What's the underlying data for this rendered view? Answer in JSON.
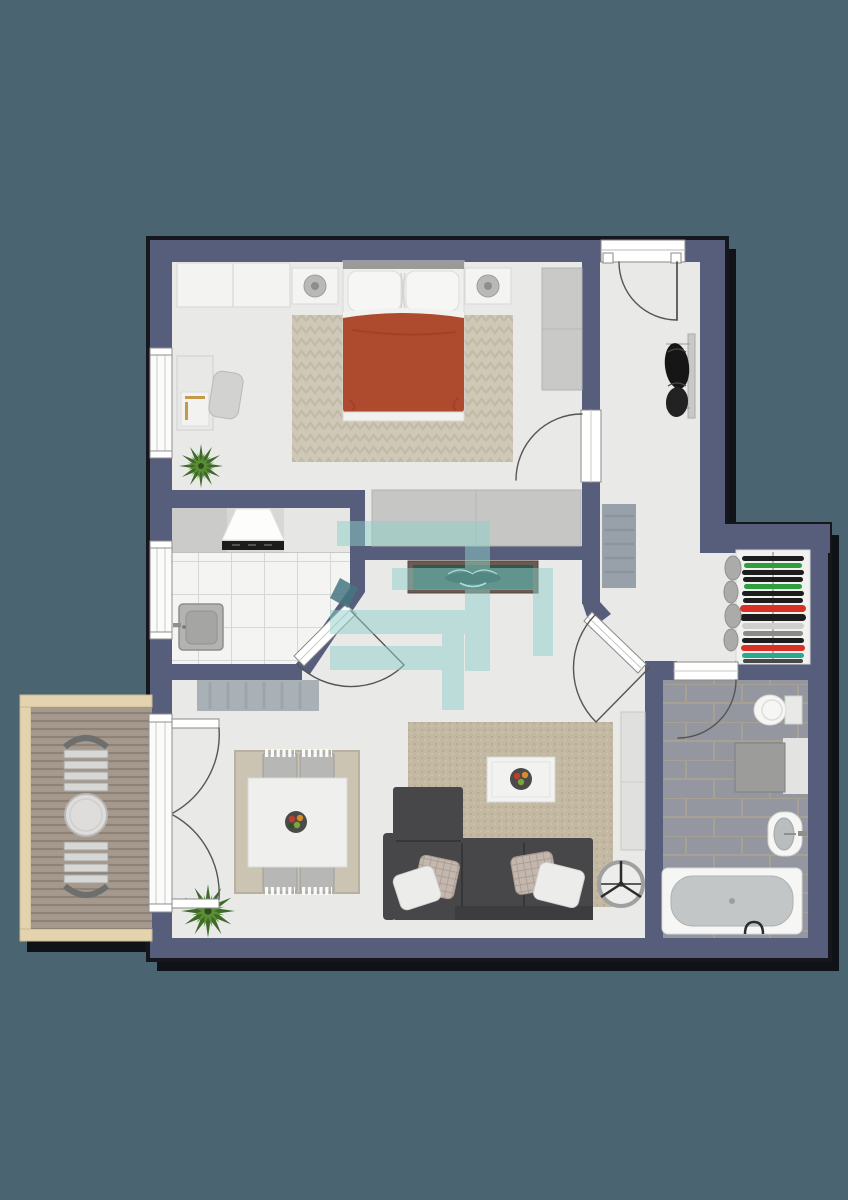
{
  "scene": {
    "type": "floor-plan",
    "view": "top-down-render",
    "description": "Furnished apartment floor plan: bedroom, kitchen, entrance hallway, walk-in wardrobe nook, bathroom, combined living/dining room and a wooden balcony, overlaid with a translucent teal logo watermark"
  },
  "colors": {
    "background": "#4a6571",
    "shadow": "#07090c",
    "wall": "#575e7c",
    "floor": "#e9e9e8",
    "kitchen_tile": "#f4f4f3",
    "bathroom_tile": "#9597a0",
    "bedroom_rug": "#cfc8b7",
    "living_rug": "#c3b8a2",
    "dining_rug": "#ccc4b3",
    "deck": "#a4978c",
    "deck_frame": "#e3d3ae",
    "duvet": "#ae4a2e",
    "sofa": "#474749",
    "watermark": "#8ed1c9",
    "console_top": "#32574f",
    "plant": "#3f6b28",
    "fixture_white": "#f6f6f5",
    "clothes_palette": [
      "#1d1d1d",
      "#2f9e3f",
      "#d93026",
      "#2aa98c",
      "#cfcfcd",
      "#8a8a88"
    ]
  },
  "watermark": {
    "description": "translucent stylized spiral-S logo over hallway",
    "opacity": 0.5
  },
  "rooms": [
    {
      "name": "bedroom",
      "objects": [
        "double bed with terracotta duvet and two pillows",
        "nightstand with lamp x2",
        "dresser",
        "tall side wardrobe",
        "low closet on south wall",
        "desk with chair",
        "herringbone rug",
        "potted plant",
        "window"
      ]
    },
    {
      "name": "kitchen",
      "objects": [
        "counter run",
        "extractor hood with cooktop",
        "corner sink",
        "white tiled floor",
        "window",
        "angled door"
      ]
    },
    {
      "name": "hallway",
      "objects": [
        "entrance door",
        "doormat",
        "console table with decor",
        "wall coat rack",
        "open wardrobe with folded clothes"
      ]
    },
    {
      "name": "bathroom",
      "objects": [
        "toilet",
        "washing machine in niche",
        "wall basin",
        "bathtub",
        "stone tiled floor",
        "door"
      ]
    },
    {
      "name": "living-dining",
      "objects": [
        "sectional sofa with cushions",
        "textured rug",
        "coffee table with fruit bowl",
        "dining table with fruit bowl",
        "dining chairs x4",
        "dining rug",
        "tall cabinet",
        "fan",
        "potted plant",
        "doormat",
        "french door to balcony"
      ]
    },
    {
      "name": "balcony",
      "objects": [
        "wooden plank deck",
        "round bistro table",
        "slatted chair x2"
      ]
    }
  ]
}
